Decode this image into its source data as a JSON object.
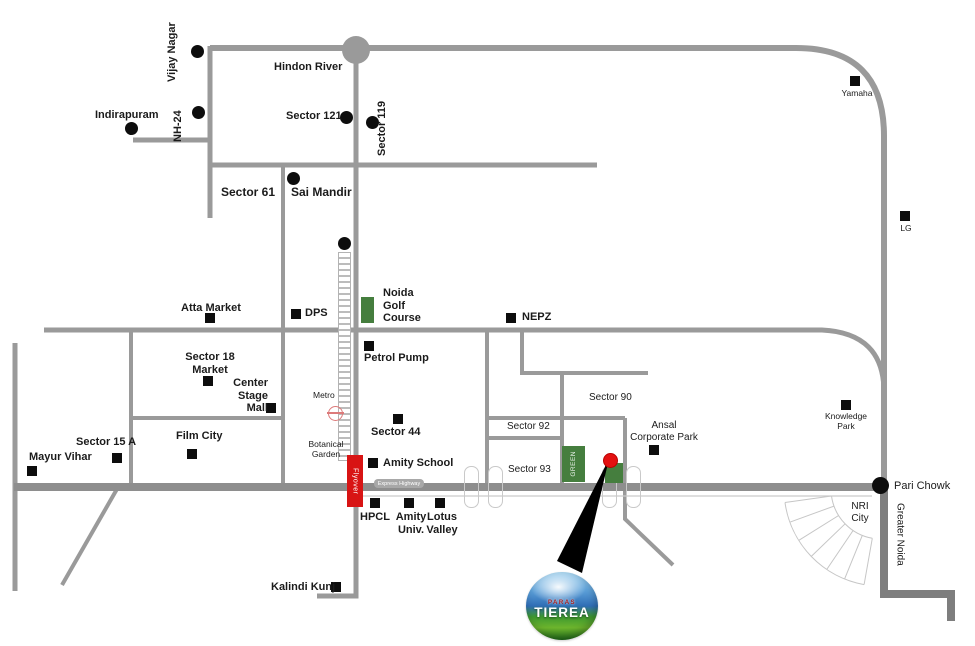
{
  "map_title": "Paras Tierea location map",
  "colors": {
    "road": "#9a9a9a",
    "highway": "#8e8e8e",
    "dark_road": "#7e7e7e",
    "flyover_red": "#d81414",
    "green": "#457e3e",
    "site_red_dot": "#e31111",
    "marker_black": "#0d0d0d",
    "logo_blue": "#2f6db5",
    "logo_green": "#3f9a2f"
  },
  "labels": {
    "vijay_nagar": "Vijay Nagar",
    "nh24": "NH-24",
    "indirapuram": "Indirapuram",
    "hindon_river": "Hindon River",
    "sector_121": "Sector 121",
    "sector_119": "Sector 119",
    "yamaha": "Yamaha",
    "lg": "LG",
    "sector_61": "Sector 61",
    "sai_mandir": "Sai Mandir",
    "atta_market": "Atta Market",
    "dps": "DPS",
    "noida_golf_course": "Noida\nGolf\nCourse",
    "nepz": "NEPZ",
    "sector_18_market": "Sector 18\nMarket",
    "center_stage_mall": "Center\nStage\nMall",
    "petrol_pump": "Petrol Pump",
    "metro": "Metro",
    "sector_44": "Sector 44",
    "film_city": "Film City",
    "sector_15a": "Sector 15 A",
    "mayur_vihar": "Mayur Vihar",
    "botanical_garden": "Botanical\nGarden",
    "amity_school": "Amity School",
    "sector_90": "Sector 90",
    "sector_92": "Sector 92",
    "sector_93": "Sector 93",
    "ansal_corporate_park": "Ansal\nCorporate Park",
    "knowledge_park": "Knowledge\nPark",
    "hpcl": "HPCL",
    "amity_univ": "Amity\nUniv.",
    "lotus_valley": "Lotus\nValley",
    "kalindi_kunj": "Kalindi Kunj",
    "pari_chowk": "Pari Chowk",
    "nri_city": "NRI\nCity",
    "greater_noida": "Greater Noida",
    "express_highway": "Express Highway",
    "flyover": "Flyover",
    "green_strip": "GREEN",
    "logo_top": "PARAS",
    "logo_main": "TIEREA"
  }
}
